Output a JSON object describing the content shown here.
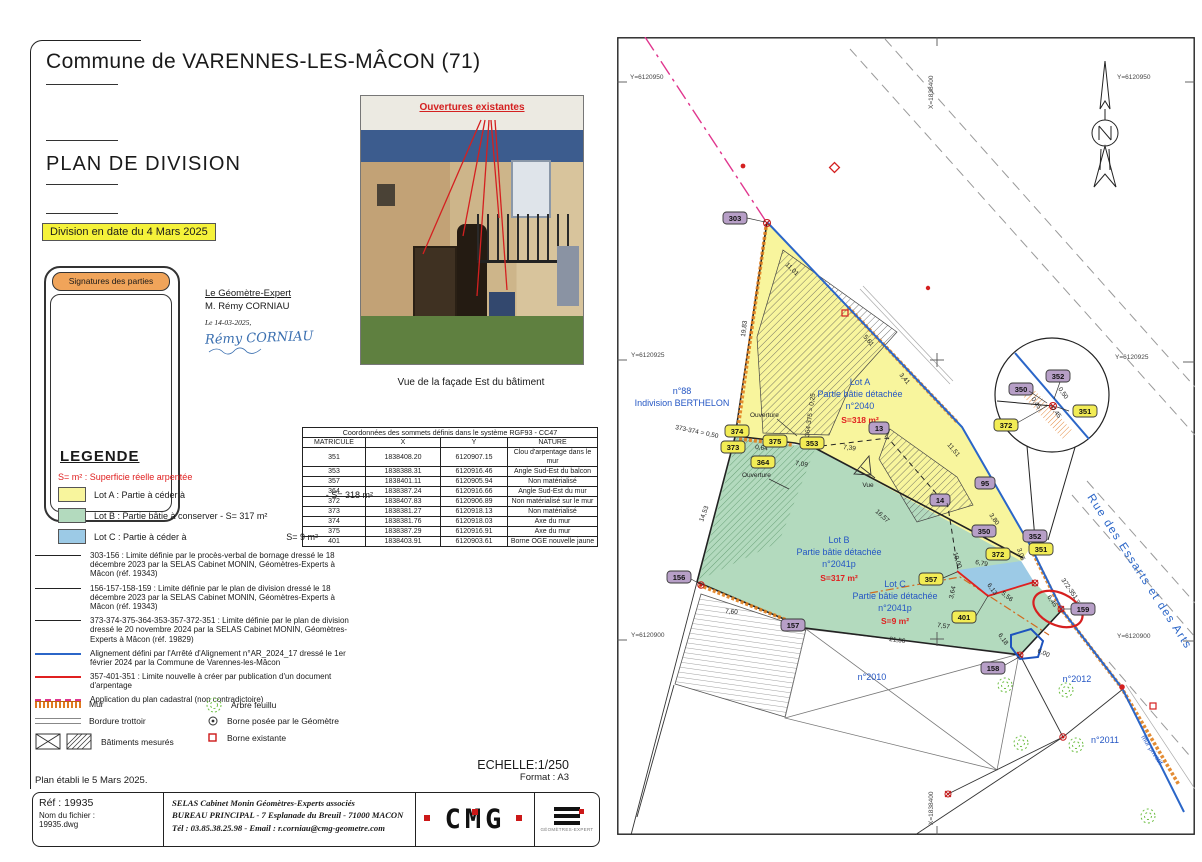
{
  "header": {
    "commune": "Commune de VARENNES-LES-MÂCON (71)",
    "doc_title": "PLAN DE DIVISION",
    "division_date": "Division en date du 4 Mars 2025",
    "signatures_title": "Signatures des parties",
    "surveyor_role": "Le Géomètre-Expert",
    "surveyor_name": "M. Rémy CORNIAU",
    "signature_date": "Le 14-03-2025,",
    "signature_name": "Rémy CORNIAU"
  },
  "photo": {
    "annotation": "Ouvertures existantes",
    "caption": "Vue de la façade Est du bâtiment"
  },
  "coords_table": {
    "title": "Coordonnées des sommets définis dans le système RGF93 - CC47",
    "headers": [
      "MATRICULE",
      "X",
      "Y",
      "NATURE"
    ],
    "rows": [
      [
        "351",
        "1838408.20",
        "6120907.15",
        "Clou d'arpentage dans le mur"
      ],
      [
        "353",
        "1838388.31",
        "6120916.46",
        "Angle Sud-Est du balcon"
      ],
      [
        "357",
        "1838401.11",
        "6120905.94",
        "Non matérialisé"
      ],
      [
        "364",
        "1838387.24",
        "6120916.66",
        "Angle Sud-Est du mur"
      ],
      [
        "372",
        "1838407.83",
        "6120906.89",
        "Non matérialisé sur le mur"
      ],
      [
        "373",
        "1838381.27",
        "6120918.13",
        "Non matérialisé"
      ],
      [
        "374",
        "1838381.76",
        "6120918.03",
        "Axe du mur"
      ],
      [
        "375",
        "1838387.29",
        "6120916.91",
        "Axe du mur"
      ],
      [
        "401",
        "1838403.91",
        "6120903.61",
        "Borne OGE nouvelle jaune"
      ]
    ]
  },
  "legend": {
    "title": "LEGENDE",
    "note": "S= m² : Superficie réelle arpentée",
    "lot_a_label": "Lot A : Partie à céder à",
    "lot_a_area": "- S= 318 m²",
    "lot_b_label": "Lot B : Partie bâtie à conserver - S= 317 m²",
    "lot_c_label": "Lot C : Partie à céder à",
    "lot_c_area": "S= 9 m²",
    "lines": [
      "303-156 : Limite définie par le procès-verbal de bornage dressé le 18 décembre 2023 par la SELAS Cabinet MONIN, Géomètres-Experts à Mâcon (réf. 19343)",
      "156-157-158-159 : Limite définie par le plan de division dressé le 18 décembre 2023 par la SELAS Cabinet MONIN, Géomètres-Experts à Mâcon (réf. 19343)",
      "373-374-375-364-353-357-372-351 : Limite définie par le plan de division dressé le 20 novembre 2024 par la SELAS Cabinet MONIN, Géomètres-Experts à Mâcon (réf. 19829)",
      "Alignement défini par l'Arrêté d'Alignement n°AR_2024_17 dressé le 1er février 2024 par la Commune de Varennes-les-Mâcon",
      "357-401-351 : Limite nouvelle à créer par publication d'un document d'arpentage",
      "Application du plan cadastral (non contradictoire)"
    ],
    "mur": "Mur",
    "bordure": "Bordure trottoir",
    "batiments": "Bâtiments mesurés",
    "arbre": "Arbre feuillu",
    "borne_posee": "Borne posée par le Géomètre",
    "borne_existante": "Borne existante",
    "established": "Plan établi le 5 Mars 2025."
  },
  "titleblock": {
    "scale": "ECHELLE:1/250",
    "format": "Format : A3",
    "ref": "Réf : 19935",
    "file_label": "Nom du fichier :",
    "file_name": "19935.dwg",
    "firm_line1": "SELAS Cabinet Monin Géomètres-Experts associés",
    "firm_line2": "BUREAU PRINCIPAL - 7 Esplanade du Breuil - 71000 MACON",
    "firm_line3": "Tél : 03.85.38.25.98 - Email : r.corniau@cmg-geometre.com",
    "logo_cmg": "CMG",
    "logo_ge": "GÉOMÈTRES-EXPERT"
  },
  "plan": {
    "grid": {
      "y950": "Y=6120950",
      "y925": "Y=6120925",
      "y900": "Y=6120900",
      "x400": "X=1838400"
    },
    "labels": {
      "n88_line1": "n°88",
      "n88_line2": "Indivision BERTHELON",
      "lota_1": "Lot A",
      "lota_2": "Partie bâtie détachée",
      "lota_3": "n°2040",
      "lota_s": "S=318 m²",
      "lotb_1": "Lot B",
      "lotb_2": "Partie bâtie détachée",
      "lotb_3": "n°2041p",
      "lotb_s": "S=317 m²",
      "lotc_1": "Lot C",
      "lotc_2": "Partie bâtie détachée",
      "lotc_3": "n°2041p",
      "lotc_s": "S=9 m²",
      "p2010": "n°2010",
      "p2011": "n°2011",
      "p2012": "n°2012",
      "street": "Rue des Essarts et des Arts",
      "mur_privatif": "mur privatif",
      "vue": "Vue",
      "ouverture1": "Ouverture",
      "ouverture2": "Ouverture"
    },
    "pts": {
      "p303": "303",
      "p350": "350",
      "p351": "351",
      "p352": "352",
      "p353": "353",
      "p357": "357",
      "p364": "364",
      "p372": "372",
      "p373": "373",
      "p374": "374",
      "p375": "375",
      "p401": "401",
      "p13": "13",
      "p14": "14",
      "p95": "95",
      "p156": "156",
      "p157": "157",
      "p158": "158",
      "p159": "159",
      "d350": "350",
      "d351": "351",
      "d352": "352",
      "d372": "372"
    },
    "dims": [
      "11,01",
      "19,83",
      "5,61",
      "3,41",
      "11,51",
      "373-374 = 0,50",
      "0,64",
      "364-375 = 0,25",
      "7,39",
      "7,09",
      "16,57",
      "14,53",
      "10,00",
      "6,79",
      "6,13",
      "5,56",
      "3,64",
      "3,05",
      "372-351 = 0,45",
      "6,45",
      "6,18",
      "6,00",
      "21,56",
      "7,60",
      "7,57",
      "3,80",
      "0,50",
      "0,45",
      "0,45"
    ]
  },
  "colors": {
    "lot_a": "#f8f59d",
    "lot_b": "#b3dabe",
    "lot_c": "#9ccae6",
    "new_limit_red": "#e02020",
    "alignment_blue": "#2b66c8",
    "cadastral_pink": "#e0368e",
    "highlight_yellow": "#f5f23a",
    "signatures_orange": "#f0a45a",
    "wall_orange": "#e07820"
  }
}
